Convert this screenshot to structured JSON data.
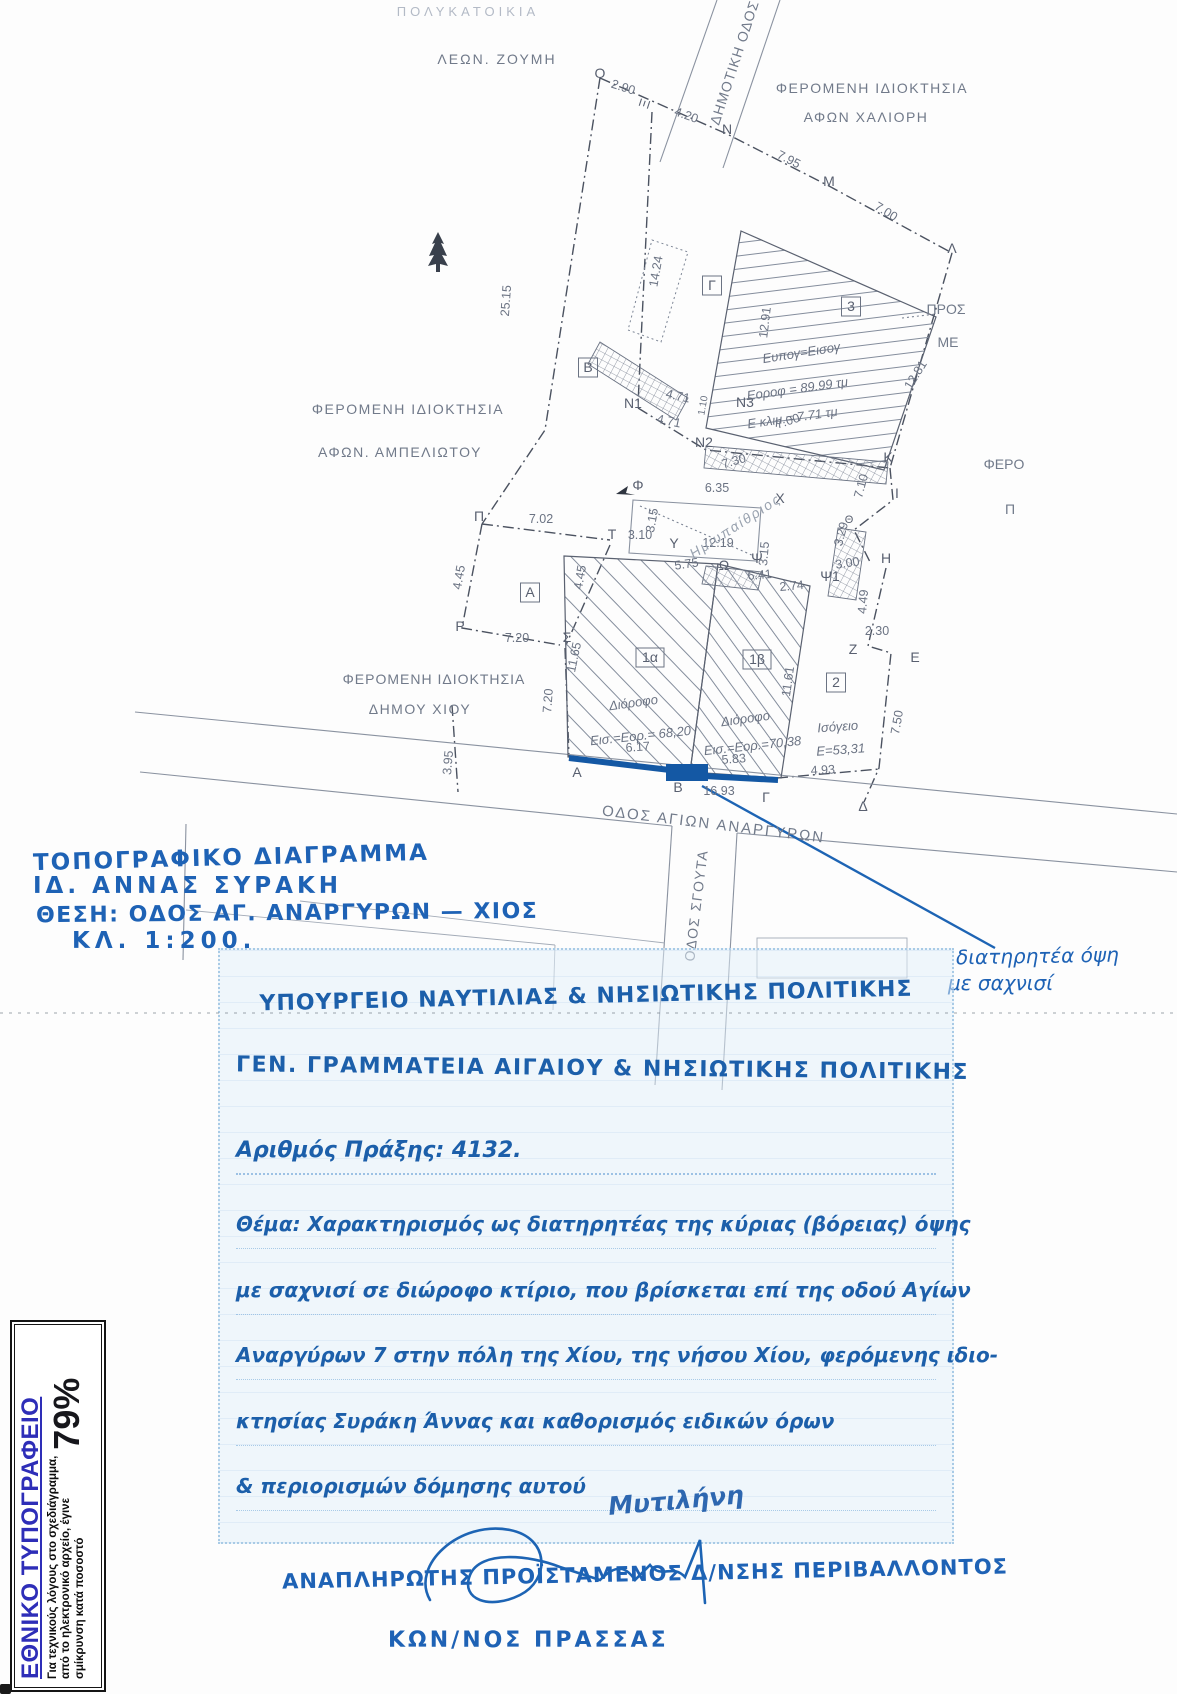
{
  "colors": {
    "ink_blue": "#1e62b5",
    "stamp_blue": "#1c5faa",
    "facade_highlight_blue": "#1458a4",
    "plan_gray": "#6b7383",
    "printing_title_blue": "#2e2eb8"
  },
  "plan": {
    "labels": [
      {
        "t": "ΠΟΛΥΚΑΤΟΙΚΙΑ",
        "x": 468,
        "y": 16,
        "c": "own-f",
        "ls": 4
      },
      {
        "t": "ΛΕΩΝ. ΖΟΥΜΗ",
        "x": 497,
        "y": 64,
        "c": "own",
        "ls": 2
      },
      {
        "t": "ΔΗΜΟΤΙΚΗ ΟΔΟΣ",
        "x": 739,
        "y": 64,
        "r": -72,
        "c": "own",
        "ls": 1
      },
      {
        "t": "ΦΕΡΟΜΕΝΗ ΙΔΙΟΚΤΗΣΙΑ",
        "x": 872,
        "y": 93,
        "c": "own",
        "ls": 1.5
      },
      {
        "t": "ΑΦΩΝ ΧΑΛΙΟΡΗ",
        "x": 866,
        "y": 122,
        "c": "own",
        "ls": 1.5
      },
      {
        "t": "ΦΕΡΟΜΕΝΗ ΙΔΙΟΚΤΗΣΙΑ",
        "x": 408,
        "y": 414,
        "c": "own",
        "ls": 1.5
      },
      {
        "t": "ΑΦΩΝ. ΑΜΠΕΛΙΩΤΟΥ",
        "x": 400,
        "y": 457,
        "c": "own",
        "ls": 1.5
      },
      {
        "t": "ΦΕΡΟΜΕΝΗ ΙΔΙΟΚΤΗΣΙΑ",
        "x": 434,
        "y": 684,
        "c": "own",
        "ls": 1
      },
      {
        "t": "ΔΗΜΟΥ ΧΙΟΥ",
        "x": 420,
        "y": 714,
        "c": "own",
        "ls": 1.5
      },
      {
        "t": "ΟΔΟΣ ΑΓΙΩΝ ΑΝΑΡΓΥΡΩΝ",
        "x": 713,
        "y": 829,
        "r": 7,
        "c": "own",
        "ls": 2,
        "fs": 15
      },
      {
        "t": "ΟΔΟΣ ΣΓΟΥΤΑ",
        "x": 701,
        "y": 906,
        "r": -83,
        "c": "own",
        "ls": 1.5
      },
      {
        "t": "ΠΡΟΣ",
        "x": 946,
        "y": 314,
        "c": "own"
      },
      {
        "t": "ΜΕ",
        "x": 948,
        "y": 347,
        "c": "own"
      },
      {
        "t": "ΦΕΡΟ",
        "x": 1004,
        "y": 469,
        "c": "own"
      },
      {
        "t": "Π",
        "x": 1010,
        "y": 514,
        "c": "own"
      },
      {
        "t": "Ο",
        "x": 600,
        "y": 78,
        "c": "pt"
      },
      {
        "t": "Ξ",
        "x": 649,
        "y": 105,
        "r": -72,
        "c": "pt"
      },
      {
        "t": "Ν",
        "x": 727,
        "y": 134,
        "c": "pt"
      },
      {
        "t": "Μ",
        "x": 829,
        "y": 186,
        "c": "pt"
      },
      {
        "t": "Λ",
        "x": 952,
        "y": 253,
        "c": "pt"
      },
      {
        "t": "Κ",
        "x": 888,
        "y": 462,
        "c": "pt"
      },
      {
        "t": "Ι",
        "x": 897,
        "y": 498,
        "c": "pt"
      },
      {
        "t": "Θ",
        "x": 849,
        "y": 523,
        "c": "pt",
        "fs": 11
      },
      {
        "t": "Η",
        "x": 886,
        "y": 563,
        "c": "pt"
      },
      {
        "t": "Ζ",
        "x": 853,
        "y": 654,
        "c": "pt"
      },
      {
        "t": "Ε",
        "x": 915,
        "y": 662,
        "c": "pt"
      },
      {
        "t": "Δ",
        "x": 863,
        "y": 811,
        "c": "pt"
      },
      {
        "t": "Γ",
        "x": 766,
        "y": 802,
        "c": "pt"
      },
      {
        "t": "Β",
        "x": 678,
        "y": 792,
        "c": "pt"
      },
      {
        "t": "Α",
        "x": 577,
        "y": 777,
        "c": "pt"
      },
      {
        "t": "Ρ",
        "x": 460,
        "y": 631,
        "c": "pt"
      },
      {
        "t": "Π",
        "x": 479,
        "y": 521,
        "c": "pt"
      },
      {
        "t": "Σ",
        "x": 567,
        "y": 642,
        "c": "pt"
      },
      {
        "t": "Τ",
        "x": 612,
        "y": 539,
        "c": "pt"
      },
      {
        "t": "Υ",
        "x": 674,
        "y": 548,
        "c": "pt"
      },
      {
        "t": "Φ",
        "x": 638,
        "y": 490,
        "c": "pt"
      },
      {
        "t": "Χ",
        "x": 780,
        "y": 503,
        "c": "pt"
      },
      {
        "t": "Ψ",
        "x": 757,
        "y": 563,
        "c": "pt"
      },
      {
        "t": "Ω",
        "x": 724,
        "y": 570,
        "c": "pt"
      },
      {
        "t": "Ψ1",
        "x": 830,
        "y": 581,
        "c": "pt"
      },
      {
        "t": "Ν1",
        "x": 633,
        "y": 408,
        "c": "pt"
      },
      {
        "t": "Ν2",
        "x": 704,
        "y": 447,
        "c": "pt"
      },
      {
        "t": "Ν3",
        "x": 745,
        "y": 407,
        "c": "pt"
      },
      {
        "t": "2.90",
        "x": 622,
        "y": 91,
        "r": 18,
        "c": "ms"
      },
      {
        "t": "4.20",
        "x": 685,
        "y": 119,
        "r": 20,
        "c": "ms"
      },
      {
        "t": "7.95",
        "x": 787,
        "y": 163,
        "r": 27,
        "c": "ms"
      },
      {
        "t": "7.00",
        "x": 884,
        "y": 215,
        "r": 32,
        "c": "ms"
      },
      {
        "t": "25.15",
        "x": 510,
        "y": 301,
        "r": -86,
        "c": "ms"
      },
      {
        "t": "14.24",
        "x": 660,
        "y": 272,
        "r": -80,
        "c": "ms"
      },
      {
        "t": "12.91",
        "x": 769,
        "y": 323,
        "r": -83,
        "c": "ms"
      },
      {
        "t": "12.81",
        "x": 919,
        "y": 377,
        "r": -58,
        "c": "ms"
      },
      {
        "t": "4.71",
        "x": 677,
        "y": 400,
        "r": 12,
        "c": "ms"
      },
      {
        "t": "1.10",
        "x": 706,
        "y": 406,
        "r": -80,
        "c": "ms",
        "fs": 10
      },
      {
        "t": "4.71",
        "x": 668,
        "y": 425,
        "r": 12,
        "c": "ms"
      },
      {
        "t": "7.00",
        "x": 789,
        "y": 425,
        "r": -18,
        "c": "ms"
      },
      {
        "t": "7.30",
        "x": 735,
        "y": 465,
        "r": -16,
        "c": "ms"
      },
      {
        "t": "7.10",
        "x": 865,
        "y": 487,
        "r": -75,
        "c": "ms"
      },
      {
        "t": "3.29",
        "x": 845,
        "y": 535,
        "r": -75,
        "c": "ms"
      },
      {
        "t": "6.35",
        "x": 717,
        "y": 492,
        "c": "ms"
      },
      {
        "t": "3.15",
        "x": 656,
        "y": 521,
        "r": -80,
        "c": "ms"
      },
      {
        "t": "12.19",
        "x": 718,
        "y": 547,
        "c": "ms"
      },
      {
        "t": "3.15",
        "x": 768,
        "y": 554,
        "r": -85,
        "c": "ms"
      },
      {
        "t": "3.10",
        "x": 640,
        "y": 539,
        "c": "ms"
      },
      {
        "t": "5.75",
        "x": 687,
        "y": 568,
        "r": -8,
        "c": "ms"
      },
      {
        "t": "6.41",
        "x": 760,
        "y": 579,
        "r": -5,
        "c": "ms"
      },
      {
        "t": "2.74",
        "x": 792,
        "y": 590,
        "r": -5,
        "c": "ms"
      },
      {
        "t": "3.00",
        "x": 848,
        "y": 567,
        "r": -8,
        "c": "ms"
      },
      {
        "t": "4.49",
        "x": 867,
        "y": 602,
        "r": -85,
        "c": "ms"
      },
      {
        "t": "2.30",
        "x": 877,
        "y": 635,
        "c": "ms"
      },
      {
        "t": "7.50",
        "x": 901,
        "y": 723,
        "r": -80,
        "c": "ms"
      },
      {
        "t": "4.45",
        "x": 463,
        "y": 578,
        "r": -80,
        "c": "ms"
      },
      {
        "t": "7.02",
        "x": 541,
        "y": 523,
        "c": "ms"
      },
      {
        "t": "7.20",
        "x": 517,
        "y": 642,
        "c": "ms"
      },
      {
        "t": "4.45",
        "x": 584,
        "y": 578,
        "r": -80,
        "c": "ms"
      },
      {
        "t": "11.65",
        "x": 578,
        "y": 658,
        "r": -78,
        "c": "ms"
      },
      {
        "t": "7.20",
        "x": 552,
        "y": 701,
        "r": -86,
        "c": "ms"
      },
      {
        "t": "11.61",
        "x": 792,
        "y": 682,
        "r": -82,
        "c": "ms"
      },
      {
        "t": "3.95",
        "x": 452,
        "y": 763,
        "r": -85,
        "c": "ms"
      },
      {
        "t": "6.17",
        "x": 638,
        "y": 751,
        "r": -4,
        "c": "ms"
      },
      {
        "t": "5.83",
        "x": 734,
        "y": 763,
        "r": -4,
        "c": "ms"
      },
      {
        "t": "16.93",
        "x": 719,
        "y": 795,
        "c": "ms"
      },
      {
        "t": "4.93",
        "x": 823,
        "y": 774,
        "r": -3,
        "c": "ms"
      },
      {
        "t": "3",
        "x": 851,
        "y": 311,
        "c": "pt",
        "box": 1
      },
      {
        "t": "Β",
        "x": 588,
        "y": 372,
        "c": "pt",
        "box": 1
      },
      {
        "t": "Γ",
        "x": 712,
        "y": 290,
        "c": "pt",
        "box": 1
      },
      {
        "t": "Α",
        "x": 530,
        "y": 597,
        "c": "pt",
        "box": 1
      },
      {
        "t": "2",
        "x": 836,
        "y": 687,
        "c": "pt",
        "box": 1
      },
      {
        "t": "1α",
        "x": 650,
        "y": 662,
        "c": "pt",
        "box": 1
      },
      {
        "t": "1β",
        "x": 757,
        "y": 664,
        "c": "pt",
        "box": 1
      },
      {
        "t": "Ευπογ=Εισογ",
        "x": 802,
        "y": 357,
        "r": -9,
        "c": "bld"
      },
      {
        "t": "Εοροφ = 89.99 τμ",
        "x": 798,
        "y": 393,
        "r": -8,
        "c": "bld"
      },
      {
        "t": "Ε κλιμ.= 7.71 τμ",
        "x": 793,
        "y": 422,
        "r": -8,
        "c": "bld"
      },
      {
        "t": "Ημιυπαίθριος",
        "x": 738,
        "y": 530,
        "r": -33,
        "c": "bld-f",
        "ls": 2
      },
      {
        "t": "Διόροφο",
        "x": 634,
        "y": 707,
        "r": -8,
        "c": "bld"
      },
      {
        "t": "Εισ.=Εορ.= 68,20",
        "x": 641,
        "y": 740,
        "r": -6,
        "c": "bld"
      },
      {
        "t": "Διόροφο",
        "x": 746,
        "y": 723,
        "r": -8,
        "c": "bld"
      },
      {
        "t": "Εισ.=Εορ.=70,38",
        "x": 753,
        "y": 750,
        "r": -6,
        "c": "bld"
      },
      {
        "t": "Ισόγειο",
        "x": 838,
        "y": 731,
        "r": -4,
        "c": "bld"
      },
      {
        "t": "Ε=53,31",
        "x": 841,
        "y": 754,
        "r": -4,
        "c": "bld"
      }
    ]
  },
  "handnote": {
    "line1": "ΤΟΠΟΓΡΑΦΙΚΟ ΔΙΑΓΡΑΜΜΑ",
    "line2": "ΙΔ. ΑΝΝΑΣ ΣΥΡΑΚΗ",
    "line3": "ΘΕΣΗ: ΟΔΟΣ ΑΓ. ΑΝΑΡΓΥΡΩΝ — ΧΙΟΣ",
    "line4": "ΚΛ. 1:200."
  },
  "preserve_note": {
    "line1": "διατηρητέα όψη",
    "line2": "με σαχνισί"
  },
  "stamp": {
    "ministry": "ΥΠΟΥΡΓΕΙΟ ΝΑΥΤΙΛΙΑΣ & ΝΗΣΙΩΤΙΚΗΣ ΠΟΛΙΤΙΚΗΣ",
    "secretariat": "ΓΕΝ. ΓΡΑΜΜΑΤΕΙΑ ΑΙΓΑΙΟΥ & ΝΗΣΙΩΤΙΚΗΣ ΠΟΛΙΤΙΚΗΣ",
    "act_number": "Αριθμός Πράξης: 4132.",
    "subject": [
      "Θέμα: Χαρακτηρισμός ως διατηρητέας της κύριας (βόρειας) όψης",
      "με σαχνισί σε διώροφο κτίριο, που βρίσκεται επί της οδού Αγίων",
      "Αναργύρων 7 στην πόλη της Χίου, της νήσου Χίου, φερόμενης ιδιο-",
      "κτησίας Συράκη Άννας και καθορισμός ειδικών όρων",
      "& περιορισμών δόμησης αυτού"
    ],
    "place_scribble": "Μυτιλήνη"
  },
  "signature": {
    "role": "ΑΝΑΠΛΗΡΩΤΗΣ ΠΡΟΪΣΤΑΜΕΝΟΣ Δ/ΝΣΗΣ ΠΕΡΙΒΑΛΛΟΝΤΟΣ",
    "name": "ΚΩΝ/ΝΟΣ ΠΡΑΣΣΑΣ"
  },
  "printing_office": {
    "title": "ΕΘΝΙΚΟ ΤΥΠΟΓΡΑΦΕΙΟ",
    "note_line1": "Για τεχνικούς λόγους στο σχεδιάγραμμα,",
    "note_line2": "από το ηλεκτρονικό αρχείο, έγινε",
    "note_line3": "σμίκρυνση κατά ποσοστό",
    "percent": "79%"
  }
}
